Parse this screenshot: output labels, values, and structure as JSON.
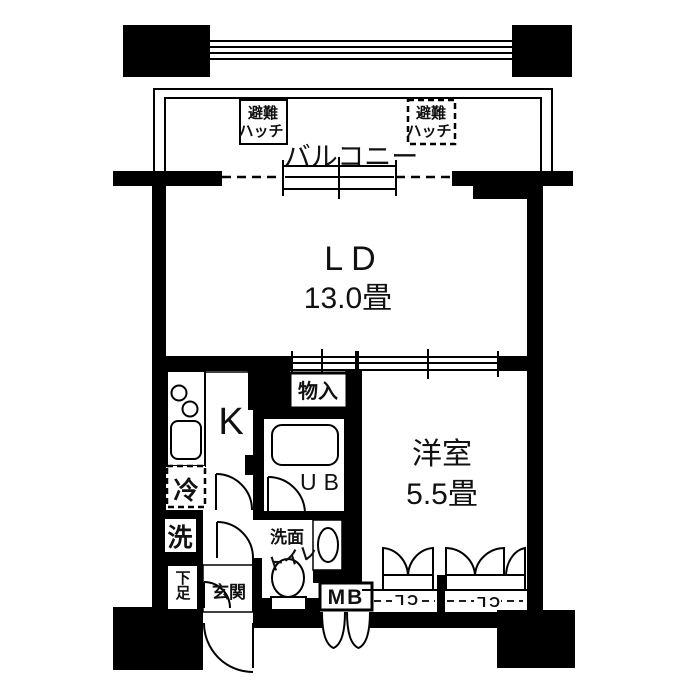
{
  "floorplan": {
    "balcony": {
      "label": "バルコニー",
      "hatch": {
        "line1": "避難",
        "line2": "ハッチ"
      }
    },
    "rooms": {
      "living": {
        "name": "LD",
        "size": "13.0畳"
      },
      "western": {
        "name": "洋室",
        "size": "5.5畳"
      },
      "kitchen": {
        "label": "K"
      },
      "bath": {
        "label": "UB"
      },
      "storage": {
        "label": "物入"
      },
      "fridge": {
        "label": "冷"
      },
      "washer": {
        "label": "洗"
      },
      "washroom": {
        "label": "洗面"
      },
      "toilet": {
        "label": "トイレ"
      },
      "shoes": {
        "label": "下足"
      },
      "entrance": {
        "label": "玄関"
      },
      "meter": {
        "label": "MB"
      },
      "closet_left": {
        "label": "CL"
      },
      "closet_right": {
        "label": "CL"
      }
    },
    "colors": {
      "wall": "#000000",
      "floor": "#ffffff",
      "line": "#111111"
    }
  }
}
